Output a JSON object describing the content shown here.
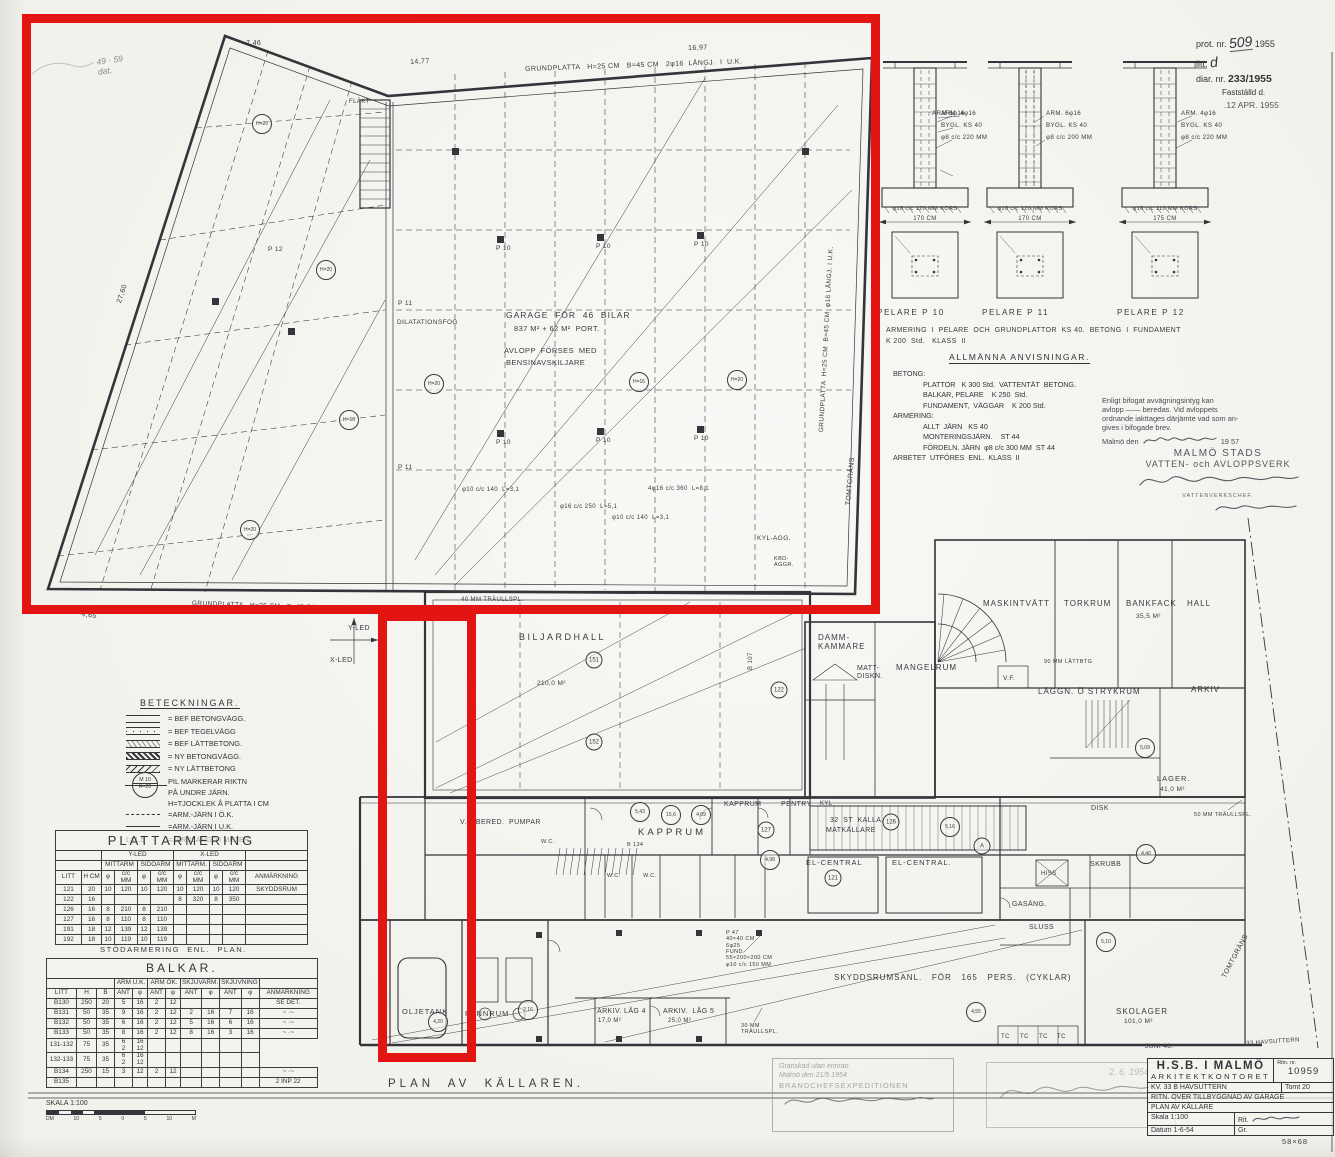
{
  "colors": {
    "paper": "#f2f1ec",
    "ink": "#34343a",
    "red": "#e31512",
    "faint": "#8a8a92"
  },
  "admin_block": {
    "prot_label": "prot. nr.",
    "prot_value": "509",
    "prot_year": "1955",
    "litt_label": "litt.",
    "litt_value": "d",
    "diar_label": "diar. nr.",
    "diar_value": "233/1955",
    "fastst_label": "Fastställd d.",
    "fastst_date": ".12 APR. 1955"
  },
  "pelare": {
    "columns": [
      {
        "name": "PELARE  P 10",
        "arm": "ARM. 4φ16",
        "bygl": "BYGL. KS 40",
        "spiral": "φ8 c/c 220 MM",
        "foot": "φ10 c/c 120 MM  KORS",
        "width": "170 CM"
      },
      {
        "name": "PELARE  P 11",
        "arm_left": "ARM 6φ16",
        "arm": "ARM. 6φ16",
        "bygl": "BYGL. KS 40",
        "spiral": "φ8 c/c 200 MM",
        "foot": "φ10 c/c 120 MM  KORS",
        "width": "170 CM"
      },
      {
        "name": "PELARE  P 12",
        "arm": "ARM. 4φ16",
        "bygl": "BYGL. KS 40",
        "spiral": "φ8 c/c 220 MM",
        "foot": "φ10 c/c 110 MM  KORS",
        "width": "175 CM"
      }
    ],
    "note1": "ARMERING  I  PELARE  OCH  GRUNDPLATTOR  KS 40.  BETONG  I  FUNDAMENT",
    "note2": "K 200  Std.   KLASS  II"
  },
  "anvisningar": {
    "title": "ALLMÄNNA   ANVISNINGAR.",
    "lines": [
      {
        "t": "BETONG:",
        "ind": 0
      },
      {
        "t": "PLATTOR   K 300 Std.  VATTENTÄT  BETONG.",
        "ind": 30
      },
      {
        "t": "BALKAR, PELARE    K 250  Std.",
        "ind": 30
      },
      {
        "t": "FUNDAMENT,  VÄGGAR    K 200 Std.",
        "ind": 30
      },
      {
        "t": "ARMERING:",
        "ind": 0
      },
      {
        "t": "ALLT  JÄRN   KS 40",
        "ind": 30
      },
      {
        "t": "MONTERINGSJÄRN.    ST 44",
        "ind": 30
      },
      {
        "t": "FÖRDELN. JÄRN  φ8 c/c 300 MM  ST 44",
        "ind": 30
      },
      {
        "t": "ARBETET  UTFÖRES  ENL.  KLASS  II",
        "ind": 0
      }
    ]
  },
  "va_stamp": {
    "lines": [
      "Enligt bifogat avvägningsintyg kan",
      "avlopp  ——  beredas.  Vid avloppets",
      "ordnande iakttages därjämte vad som an-",
      "gives i bifogade brev."
    ],
    "date_prefix": "Malmö den",
    "date_year": "19 57",
    "org1": "MALMÖ STADS",
    "org2": "VATTEN- och AVLOPPSVERK",
    "role": "VATTENVERKSCHEF."
  },
  "beteckningar": {
    "title": "BETECKNINGAR.",
    "wall_items": [
      "=  BEF   BETONGVÄGG.",
      "=  BEF   TEGELVÄGG",
      "=  BEF   LÄTTBETONG.",
      "=  NY   BETONGVÄGG.",
      "=  NY   LÄTTBETONG"
    ],
    "notes": [
      "PIL  MARKERAR  RIKTN",
      "PÅ  UNDRE  JÄRN.",
      "H=TJOCKLEK  Å  PLATTA  I  CM"
    ],
    "sym_top": "M 10",
    "sym_bot": "H=20",
    "arm_ok": "=ARM.-JÄRN  I  Ö.K.",
    "arm_uk": "=ARM.-JÄRN  I  U.K.",
    "arm_len_prefix": "L=1,5",
    "arm_len": "=JÄRNLÄNGD  I  METER."
  },
  "plattarmering": {
    "title": "PLATTARMERING",
    "yled": "Y-LED",
    "xled": "X-LED",
    "mittarm": "MITTARM",
    "sidoarm": "SIDOARM",
    "mittarm2": "MITTARM.",
    "sidoarm2": "SIDOARM",
    "litt": "LITT",
    "hcm": "H CM",
    "phi": "φ",
    "cc": "c/c MM",
    "anm": "ANMÄRKNING",
    "rows": [
      [
        "121",
        "20",
        "10",
        "120",
        "10",
        "120",
        "10",
        "120",
        "10",
        "120",
        "SKYDDSRUM"
      ],
      [
        "122",
        "16",
        "",
        "",
        "",
        "",
        "8",
        "320",
        "8",
        "350",
        ""
      ],
      [
        "126",
        "16",
        "8",
        "210",
        "8",
        "210",
        "",
        "",
        "",
        "",
        ""
      ],
      [
        "127",
        "16",
        "8",
        "110",
        "8",
        "110",
        "",
        "",
        "",
        "",
        ""
      ],
      [
        "191",
        "18",
        "12",
        "139",
        "12",
        "139",
        "",
        "",
        "",
        "",
        ""
      ],
      [
        "192",
        "18",
        "10",
        "119",
        "10",
        "119",
        "",
        "",
        "",
        "",
        ""
      ]
    ]
  },
  "stod_note": "STÖDARMERING  ENL.  PLAN.",
  "balkar": {
    "title": "BALKAR.",
    "litt": "LITT",
    "h": "H",
    "b": "B",
    "arm_uk": "ARM U.K.",
    "arm_ok": "ARM ÖK.",
    "skjuvarm": "SKJUVARM.",
    "skjuvning": "SKJUVNING",
    "ant": "ANT",
    "phi": "φ",
    "anm": "ANMÄRKNING",
    "rows": [
      [
        "B130",
        "250",
        "20",
        "5",
        "16",
        "2",
        "12",
        "",
        "",
        "",
        "",
        "SE DET."
      ],
      [
        "B131",
        "50",
        "35",
        "9",
        "16",
        "2",
        "12",
        "2",
        "16",
        "7",
        "16",
        "~ ·~"
      ],
      [
        "B132",
        "50",
        "35",
        "6",
        "16",
        "2",
        "12",
        "5",
        "16",
        "6",
        "16",
        "~ ·~"
      ],
      [
        "B133",
        "50",
        "35",
        "8",
        "16",
        "2",
        "12",
        "8",
        "16",
        "3",
        "16",
        "~ ·~"
      ],
      [
        "131-132",
        "75",
        "35",
        "6\n2",
        "16\n12",
        "",
        "",
        "",
        "",
        "",
        ""
      ],
      [
        "132-133",
        "75",
        "35",
        "6\n2",
        "16\n12",
        "",
        "",
        "",
        "",
        "",
        ""
      ],
      [
        "B134",
        "250",
        "15",
        "3",
        "12",
        "2",
        "12",
        "",
        "",
        "",
        "",
        "~ ·~"
      ],
      [
        "B135",
        "",
        "",
        "",
        "",
        "",
        "",
        "",
        "",
        "",
        "",
        "2 INP 22"
      ]
    ]
  },
  "skala": {
    "label": "SKALA  1:100",
    "unit_left": "DM",
    "ticks": [
      "10",
      "5",
      "0",
      "5",
      "10"
    ],
    "unit_right": "M"
  },
  "stamps": {
    "left": {
      "lines": [
        "Granskad utan erinran",
        "Malmö den 21/5 1954",
        "BRANDCHEFSEXPEDITIONEN"
      ]
    },
    "right": {
      "date": "2. 6. 1954"
    }
  },
  "title_block": {
    "org1": "H.S.B. I MALMÖ",
    "org2": "ARKITEKTKONTORET",
    "ritn_label": "Ritn. nr.",
    "ritn_value": "10959",
    "kv": "KV. 33 B  HAVSUTTERN",
    "tomt": "Tomt 20",
    "row3": "RITN. ÖVER TILLBYGGNAD AV GARAGE",
    "row4": "PLAN  AV  KÄLLARE",
    "skala_label": "Skala",
    "skala_value": "1:100",
    "rit_label": "Rit.",
    "gr_label": "Gr.",
    "datum_label": "Datum",
    "datum_value": "1-6-54",
    "size_note": "58×68"
  },
  "plan": {
    "caption": "PLAN  AV  KÄLLAREN.",
    "labels": [
      {
        "t": "GRUNDPLATTA   H=25 CM   B=45 CM   2φ16  LÅNGJ.  I  U.K.",
        "x": 525,
        "y": 66,
        "fs": 7,
        "r": -2
      },
      {
        "t": "7,46",
        "x": 246,
        "y": 40,
        "fs": 7
      },
      {
        "t": "14,77",
        "x": 410,
        "y": 59,
        "fs": 7,
        "r": -3
      },
      {
        "t": "16,97",
        "x": 688,
        "y": 45,
        "fs": 7,
        "r": -2
      },
      {
        "t": "27,60",
        "x": 116,
        "y": 302,
        "fs": 7,
        "r": -72
      },
      {
        "t": "FLÄKT",
        "x": 349,
        "y": 99,
        "fs": 6
      },
      {
        "t": "GARAGE  FÖR  46  BILAR",
        "x": 506,
        "y": 311,
        "fs": 8.5,
        "ls": 1
      },
      {
        "t": "837 M² + 62 M²  PORT.",
        "x": 514,
        "y": 325,
        "fs": 7.5
      },
      {
        "t": "AVLOPP  FÖRSES  MED",
        "x": 504,
        "y": 347,
        "fs": 7.5
      },
      {
        "t": "BENSINAVSKILJARE",
        "x": 506,
        "y": 359,
        "fs": 7.5
      },
      {
        "t": "DILATATIONSFOG",
        "x": 397,
        "y": 319,
        "fs": 6.5
      },
      {
        "t": "GRUNDPLATTA  H=25 CM  B=45 CM  φ16 LÅNGJ. I U.K.",
        "x": 818,
        "y": 432,
        "fs": 6.5,
        "r": -87
      },
      {
        "t": "GRUNDPLATTA   H=25 CM   B=45 CM   φ16  LÅNGJ.  I  U.K.",
        "x": 192,
        "y": 600,
        "fs": 6.5,
        "r": 2
      },
      {
        "t": "13,91",
        "x": 244,
        "y": 606,
        "fs": 7
      },
      {
        "t": "4,65",
        "x": 82,
        "y": 611,
        "fs": 7,
        "r": 8
      },
      {
        "t": "Y-LED",
        "x": 348,
        "y": 625,
        "fs": 7
      },
      {
        "t": "X-LED",
        "x": 330,
        "y": 657,
        "fs": 7
      },
      {
        "t": "P 10",
        "x": 496,
        "y": 245,
        "fs": 6.5
      },
      {
        "t": "P 10",
        "x": 596,
        "y": 243,
        "fs": 6.5
      },
      {
        "t": "P 10",
        "x": 694,
        "y": 241,
        "fs": 6.5
      },
      {
        "t": "P 10",
        "x": 496,
        "y": 439,
        "fs": 6.5
      },
      {
        "t": "P 10",
        "x": 596,
        "y": 437,
        "fs": 6.5
      },
      {
        "t": "P 10",
        "x": 694,
        "y": 435,
        "fs": 6.5
      },
      {
        "t": "P 11",
        "x": 398,
        "y": 300,
        "fs": 6.5
      },
      {
        "t": "P 11",
        "x": 398,
        "y": 464,
        "fs": 6.5
      },
      {
        "t": "P 12",
        "x": 268,
        "y": 246,
        "fs": 6.5
      },
      {
        "t": "φ10 c/c 140  L=3,1",
        "x": 462,
        "y": 487,
        "fs": 6
      },
      {
        "t": "φ16 c/c 250  L=5,1",
        "x": 560,
        "y": 504,
        "fs": 6
      },
      {
        "t": "4φ16 c/c 360  L=8,1",
        "x": 648,
        "y": 486,
        "fs": 6
      },
      {
        "t": "φ10 c/c 140  L=3,1",
        "x": 612,
        "y": 515,
        "fs": 6
      },
      {
        "t": "KYL-AGG.",
        "x": 757,
        "y": 535,
        "fs": 6.5
      },
      {
        "t": "KBD-\nAGGR.",
        "x": 774,
        "y": 556,
        "fs": 5.5
      },
      {
        "t": "40 MM TRÄULLSPL.",
        "x": 461,
        "y": 597,
        "fs": 6
      },
      {
        "t": "BILJARDHALL",
        "x": 519,
        "y": 632,
        "fs": 9,
        "ls": 2.5
      },
      {
        "t": "210,0 M²",
        "x": 537,
        "y": 680,
        "fs": 6.5
      },
      {
        "t": "TOMTGRÄNS",
        "x": 845,
        "y": 505,
        "fs": 7,
        "r": -85
      },
      {
        "t": "TOMTGRÄNS",
        "x": 1221,
        "y": 976,
        "fs": 7,
        "r": -62
      },
      {
        "t": "B 107",
        "x": 748,
        "y": 670,
        "fs": 6,
        "r": -90
      },
      {
        "t": "DAMM-\nKAMMARE",
        "x": 818,
        "y": 633,
        "fs": 8,
        "ls": 1
      },
      {
        "t": "MATT-\nDISKN.",
        "x": 857,
        "y": 665,
        "fs": 7
      },
      {
        "t": "MANGELRUM",
        "x": 896,
        "y": 663,
        "fs": 8,
        "ls": 1
      },
      {
        "t": "MASKINTVÄTT",
        "x": 983,
        "y": 599,
        "fs": 8,
        "ls": 1
      },
      {
        "t": "TORKRUM",
        "x": 1064,
        "y": 599,
        "fs": 8,
        "ls": 1
      },
      {
        "t": "BANKFACK",
        "x": 1126,
        "y": 599,
        "fs": 8,
        "ls": 1
      },
      {
        "t": "35,5 M²",
        "x": 1136,
        "y": 613,
        "fs": 6.5
      },
      {
        "t": "HALL",
        "x": 1187,
        "y": 599,
        "fs": 8,
        "ls": 1
      },
      {
        "t": "90 MM LÄTTBTG",
        "x": 1044,
        "y": 659,
        "fs": 5.5
      },
      {
        "t": "V.F.",
        "x": 1003,
        "y": 675,
        "fs": 6.5
      },
      {
        "t": "LÄGGN. Ö STRYKRUM",
        "x": 1038,
        "y": 687,
        "fs": 8,
        "ls": 1
      },
      {
        "t": "ARKIV",
        "x": 1191,
        "y": 685,
        "fs": 8,
        "ls": 1
      },
      {
        "t": "LAGER.",
        "x": 1157,
        "y": 775,
        "fs": 7.5,
        "ls": 1
      },
      {
        "t": "41,0 M²",
        "x": 1160,
        "y": 786,
        "fs": 6.5
      },
      {
        "t": "DISK",
        "x": 1091,
        "y": 805,
        "fs": 7
      },
      {
        "t": "50 MM TRÄULLSPL.",
        "x": 1194,
        "y": 812,
        "fs": 5.5
      },
      {
        "t": "KAPPRUM",
        "x": 638,
        "y": 828,
        "fs": 9.5,
        "ls": 3
      },
      {
        "t": "KAPPRUM",
        "x": 724,
        "y": 801,
        "fs": 7
      },
      {
        "t": "PENTRY",
        "x": 781,
        "y": 801,
        "fs": 7
      },
      {
        "t": "KYL",
        "x": 820,
        "y": 801,
        "fs": 6
      },
      {
        "t": "W.C.",
        "x": 607,
        "y": 873,
        "fs": 5.5
      },
      {
        "t": "W.C.",
        "x": 643,
        "y": 873,
        "fs": 5.5
      },
      {
        "t": "W.C.",
        "x": 541,
        "y": 839,
        "fs": 5.5
      },
      {
        "t": "V.V. BERED.  PUMPAR",
        "x": 460,
        "y": 819,
        "fs": 7
      },
      {
        "t": "32  ST  KALLA",
        "x": 830,
        "y": 817,
        "fs": 7
      },
      {
        "t": "MATKÄLLARE",
        "x": 826,
        "y": 827,
        "fs": 7
      },
      {
        "t": "EL-CENTRAL",
        "x": 806,
        "y": 859,
        "fs": 7.5,
        "ls": 1
      },
      {
        "t": "EL-CENTRAL.",
        "x": 892,
        "y": 859,
        "fs": 7.5,
        "ls": 1
      },
      {
        "t": "B 134",
        "x": 627,
        "y": 842,
        "fs": 5.5
      },
      {
        "t": "GASÄNG.",
        "x": 1012,
        "y": 901,
        "fs": 7
      },
      {
        "t": "SLUSS",
        "x": 1029,
        "y": 924,
        "fs": 7
      },
      {
        "t": "HISS",
        "x": 1041,
        "y": 871,
        "fs": 6
      },
      {
        "t": "SKRUBB",
        "x": 1090,
        "y": 861,
        "fs": 7
      },
      {
        "t": "P 47\n40×40 CM\n6φ25\nFUND.\n55×200×200 CM\nφ10 c/c 150 MM",
        "x": 726,
        "y": 930,
        "fs": 5.5
      },
      {
        "t": "SKYDDSRUMSANL.   FÖR   165   PERS.   (CYKLAR)",
        "x": 834,
        "y": 973,
        "fs": 8,
        "ls": 1
      },
      {
        "t": "OLJETANK",
        "x": 402,
        "y": 1008,
        "fs": 7.5,
        "ls": 1
      },
      {
        "t": "PANNRUM",
        "x": 465,
        "y": 1010,
        "fs": 7.5,
        "ls": 1
      },
      {
        "t": "ARKIV. LÅG 4",
        "x": 597,
        "y": 1008,
        "fs": 7
      },
      {
        "t": "17,0 M²",
        "x": 598,
        "y": 1018,
        "fs": 6
      },
      {
        "t": "ARKIV.  LÅG 5",
        "x": 663,
        "y": 1008,
        "fs": 7
      },
      {
        "t": "25,0 M²",
        "x": 668,
        "y": 1018,
        "fs": 6
      },
      {
        "t": "30 MM\nTRÄULLSPL.",
        "x": 741,
        "y": 1023,
        "fs": 5.5
      },
      {
        "t": "SKOLAGER",
        "x": 1116,
        "y": 1007,
        "fs": 8,
        "ls": 1
      },
      {
        "t": "101,0 M²",
        "x": 1124,
        "y": 1018,
        "fs": 6.5
      },
      {
        "t": "TC",
        "x": 1001,
        "y": 1034,
        "fs": 6
      },
      {
        "t": "TC",
        "x": 1020,
        "y": 1034,
        "fs": 6
      },
      {
        "t": "TC",
        "x": 1039,
        "y": 1034,
        "fs": 6
      },
      {
        "t": "TC",
        "x": 1057,
        "y": 1034,
        "fs": 6
      },
      {
        "t": "JUNI 48.",
        "x": 1145,
        "y": 1043,
        "fs": 6.5
      },
      {
        "t": "33 HAVSUTTERN",
        "x": 1246,
        "y": 1041,
        "fs": 6,
        "r": -4
      },
      {
        "t": "49 · 59\ndat.",
        "x": 96,
        "y": 58,
        "fs": 8.5,
        "cls": "hand",
        "r": -8
      }
    ],
    "circles": [
      {
        "t": "151",
        "x": 594,
        "y": 660
      },
      {
        "t": "152",
        "x": 594,
        "y": 742
      },
      {
        "t": "122",
        "x": 779,
        "y": 690
      },
      {
        "t": "126",
        "x": 891,
        "y": 822
      },
      {
        "t": "121",
        "x": 833,
        "y": 878
      },
      {
        "t": "127",
        "x": 766,
        "y": 830
      },
      {
        "t": "4,98",
        "x": 770,
        "y": 860
      },
      {
        "t": "5,43",
        "x": 640,
        "y": 812
      },
      {
        "t": "15,6",
        "x": 671,
        "y": 815
      },
      {
        "t": "4,09",
        "x": 701,
        "y": 815
      },
      {
        "t": "4,20",
        "x": 438,
        "y": 1022
      },
      {
        "t": "2,16",
        "x": 528,
        "y": 1010
      },
      {
        "t": "5,16",
        "x": 950,
        "y": 827
      },
      {
        "t": "A",
        "x": 982,
        "y": 846
      },
      {
        "t": "4,55",
        "x": 976,
        "y": 1012
      },
      {
        "t": "5,10",
        "x": 1106,
        "y": 942
      },
      {
        "t": "4,40",
        "x": 1146,
        "y": 854
      },
      {
        "t": "5,09",
        "x": 1145,
        "y": 748
      },
      {
        "t": "H=20",
        "x": 262,
        "y": 124
      },
      {
        "t": "H=20",
        "x": 326,
        "y": 270
      },
      {
        "t": "H=20",
        "x": 434,
        "y": 384
      },
      {
        "t": "H=16",
        "x": 639,
        "y": 382
      },
      {
        "t": "H=20",
        "x": 737,
        "y": 380
      },
      {
        "t": "H=16",
        "x": 349,
        "y": 420
      },
      {
        "t": "H=20",
        "x": 250,
        "y": 530
      }
    ]
  }
}
